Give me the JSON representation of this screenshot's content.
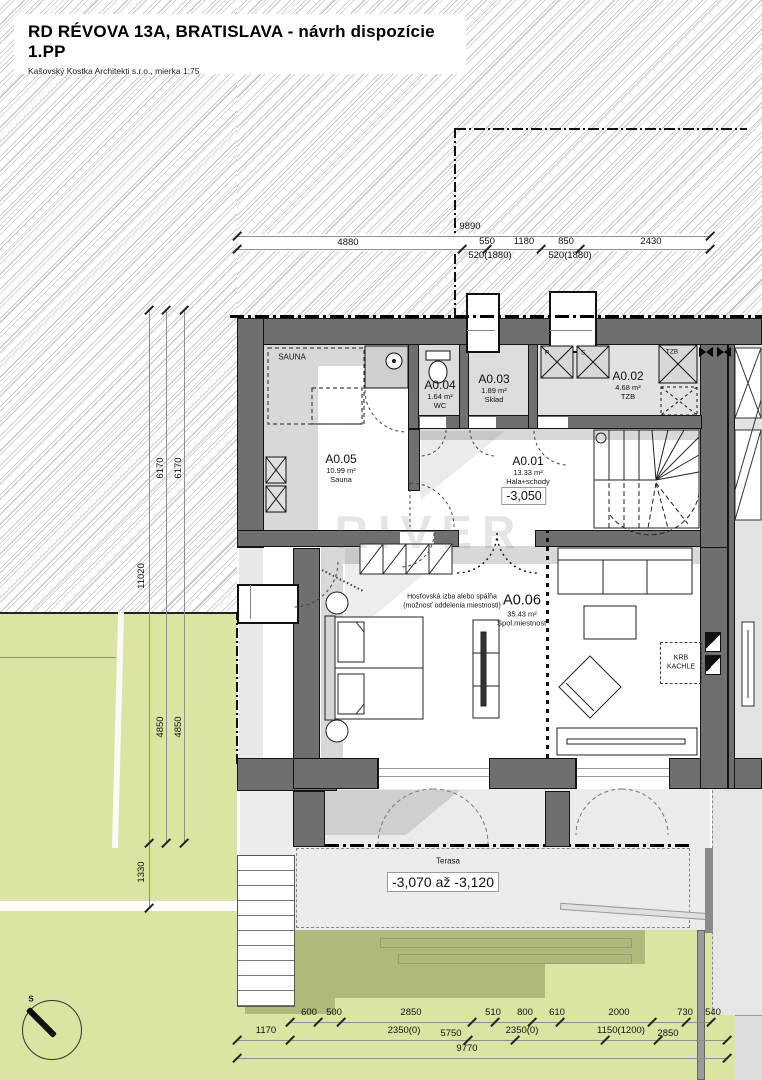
{
  "title": {
    "main": "RD RÉVOVA 13A, BRATISLAVA - návrh dispozície 1.PP",
    "sub": "Kašovský Kostka Architekti s.r.o., mierka 1:75"
  },
  "rooms": {
    "a001": {
      "id": "A0.01",
      "area": "13.33 m²",
      "name": "Hala+schody",
      "level": "-3,050"
    },
    "a002": {
      "id": "A0.02",
      "area": "4.68 m²",
      "name": "TZB"
    },
    "a003": {
      "id": "A0.03",
      "area": "1.89 m²",
      "name": "Sklad"
    },
    "a004": {
      "id": "A0.04",
      "area": "1.64 m²",
      "name": "WC"
    },
    "a005": {
      "id": "A0.05",
      "area": "10.99 m²",
      "name": "Sauna"
    },
    "a006": {
      "id": "A0.06",
      "area": "35.43 m²",
      "name": "Spol.miestnosť"
    }
  },
  "annotations": {
    "sauna_zone": "SAUNA",
    "fireplace_line1": "KRB",
    "fireplace_line2": "KACHLE",
    "terrace_label": "Terasa",
    "terrace_level": "-3,070 až -3,120",
    "guest_note_line1": "Hosťovská izba alebo spálňa",
    "guest_note_line2": "(možnosť oddelenia miestnosti)",
    "shaft_p": "P",
    "shaft_s": "S",
    "shaft_tzb": "TZB",
    "compass_north": "S",
    "watermark": "RIVER"
  },
  "dimensions": {
    "overall_top": "9890",
    "top": [
      "4880",
      "550",
      "1180",
      "850",
      "2430"
    ],
    "top_sub": [
      "520(1880)",
      "520(1880)"
    ],
    "left": [
      "6170",
      "6170",
      "11020",
      "4850",
      "4850",
      "1330"
    ],
    "bottom_row1": [
      "600",
      "500",
      "2850",
      "510",
      "800",
      "610",
      "2000",
      "730",
      "540"
    ],
    "bottom_row2": [
      "1170",
      "2350(0)",
      "5750",
      "2350(0)",
      "1150(1200)",
      "2850"
    ],
    "overall_bottom": "9770"
  },
  "colors": {
    "wall": "#6f6f6f",
    "garden": "#dde3a2",
    "garden_shadow": "#b2b77c",
    "line": "#141414"
  }
}
